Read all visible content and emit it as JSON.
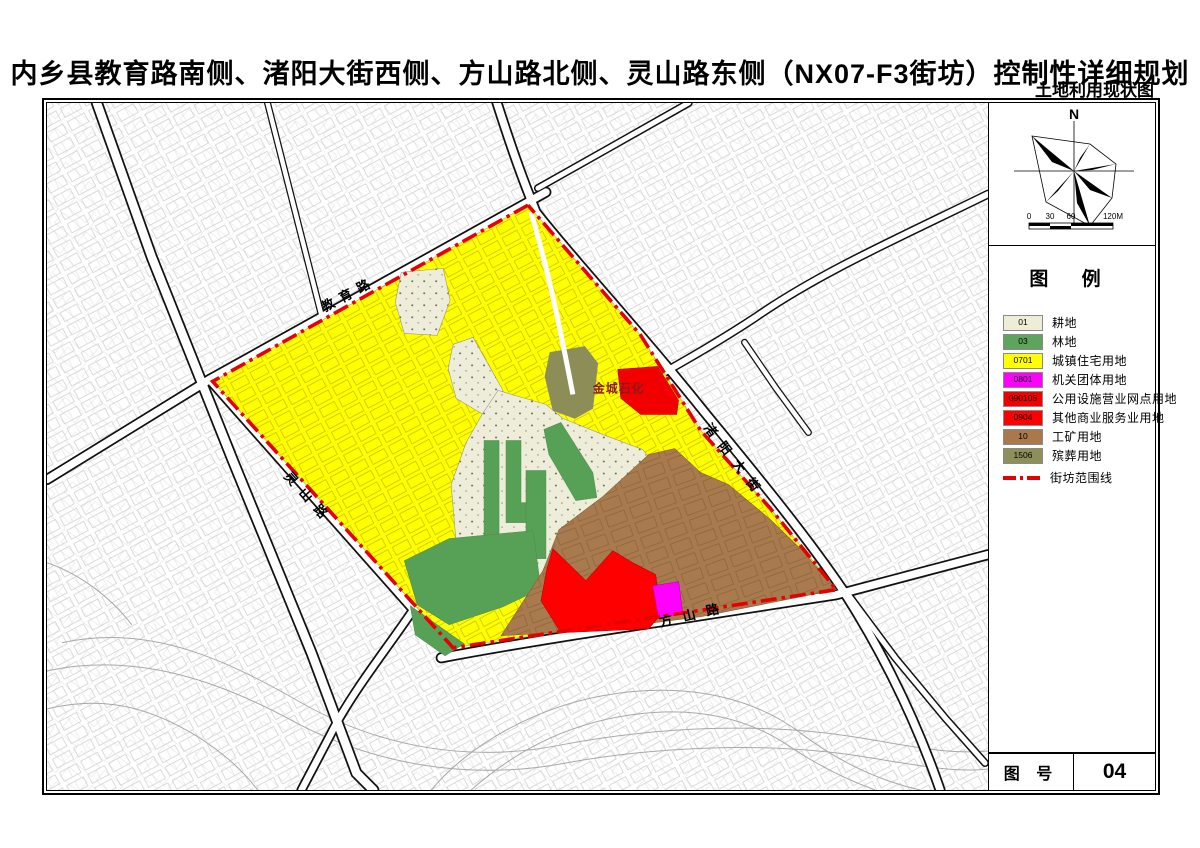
{
  "title": "内乡县教育路南侧、渚阳大街西侧、方山路北侧、灵山路东侧（NX07-F3街坊）控制性详细规划",
  "subtitle": "土地利用现状图",
  "map": {
    "road_labels": [
      {
        "text": "教育路"
      },
      {
        "text": "灵山路"
      },
      {
        "text": "方山路"
      },
      {
        "text": "渚阳大街"
      }
    ],
    "area_label": "金城石化",
    "boundary_color": "#E60000"
  },
  "panel": {
    "compass": {
      "north_label": "N"
    },
    "scale_bar": {
      "ticks": [
        "0",
        "30",
        "60",
        "120M"
      ]
    },
    "legend": {
      "title": "图    例",
      "items": [
        {
          "code": "01",
          "label": "耕地",
          "color": "#EEEDD8"
        },
        {
          "code": "03",
          "label": "林地",
          "color": "#5DA55D"
        },
        {
          "code": "0701",
          "label": "城镇住宅用地",
          "color": "#FFFF00"
        },
        {
          "code": "0801",
          "label": "机关团体用地",
          "color": "#FF00FF"
        },
        {
          "code": "090105",
          "label": "公用设施营业网点用地",
          "color": "#F20000"
        },
        {
          "code": "0904",
          "label": "其他商业服务业用地",
          "color": "#FF0000"
        },
        {
          "code": "10",
          "label": "工矿用地",
          "color": "#A9794C"
        },
        {
          "code": "1506",
          "label": "殡葬用地",
          "color": "#8F8F5A"
        }
      ],
      "boundary_item": {
        "label": "街坊范围线",
        "color": "#E60000"
      }
    },
    "figure_row": {
      "label": "图 号",
      "value": "04"
    }
  }
}
